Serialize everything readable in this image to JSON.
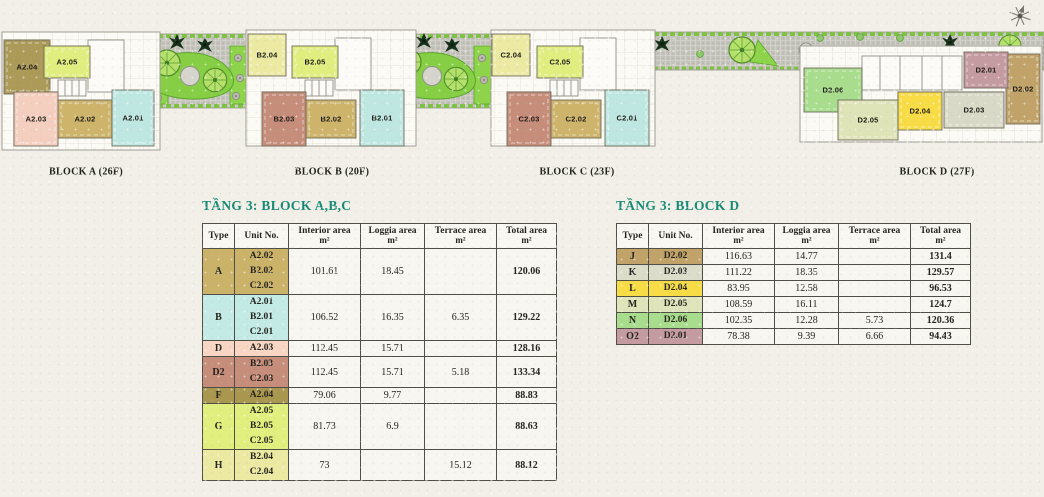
{
  "colors": {
    "title_teal": "#178a74",
    "paper": "#f1efe8",
    "table_border": "#504f47"
  },
  "plan": {
    "compass": "north-arrow",
    "blocks": [
      {
        "label": "BLOCK A (26F)",
        "cx": 86,
        "cy": 172
      },
      {
        "label": "BLOCK B (20F)",
        "cx": 332,
        "cy": 172
      },
      {
        "label": "BLOCK C (23F)",
        "cx": 577,
        "cy": 172
      },
      {
        "label": "BLOCK D (27F)",
        "cx": 937,
        "cy": 172
      }
    ],
    "units": [
      {
        "name": "A2.04",
        "color": "#ab9a58",
        "x": 4,
        "y": 40,
        "w": 46,
        "h": 54
      },
      {
        "name": "A2.05",
        "color": "#dfee7e",
        "x": 44,
        "y": 46,
        "w": 46,
        "h": 32
      },
      {
        "name": "A2.03",
        "color": "#f4cfc0",
        "x": 14,
        "y": 92,
        "w": 44,
        "h": 54
      },
      {
        "name": "A2.02",
        "color": "#cdb46a",
        "x": 58,
        "y": 100,
        "w": 54,
        "h": 38
      },
      {
        "name": "A2.01",
        "color": "#bfe7e2",
        "x": 112,
        "y": 90,
        "w": 42,
        "h": 56
      },
      {
        "name": "B2.04",
        "color": "#ece9a2",
        "x": 248,
        "y": 34,
        "w": 38,
        "h": 42
      },
      {
        "name": "B2.05",
        "color": "#dfee7e",
        "x": 292,
        "y": 46,
        "w": 46,
        "h": 32
      },
      {
        "name": "B2.03",
        "color": "#c68d7b",
        "x": 262,
        "y": 92,
        "w": 44,
        "h": 54
      },
      {
        "name": "B2.02",
        "color": "#cdb46a",
        "x": 306,
        "y": 100,
        "w": 50,
        "h": 38
      },
      {
        "name": "B2.01",
        "color": "#bfe7e2",
        "x": 360,
        "y": 90,
        "w": 44,
        "h": 56
      },
      {
        "name": "C2.04",
        "color": "#ece9a2",
        "x": 492,
        "y": 34,
        "w": 38,
        "h": 42
      },
      {
        "name": "C2.05",
        "color": "#dfee7e",
        "x": 537,
        "y": 46,
        "w": 46,
        "h": 32
      },
      {
        "name": "C2.03",
        "color": "#c68d7b",
        "x": 507,
        "y": 92,
        "w": 44,
        "h": 54
      },
      {
        "name": "C2.02",
        "color": "#cdb46a",
        "x": 551,
        "y": 100,
        "w": 50,
        "h": 38
      },
      {
        "name": "C2.01",
        "color": "#bfe7e2",
        "x": 605,
        "y": 90,
        "w": 44,
        "h": 56
      },
      {
        "name": "D2.06",
        "color": "#a9dd8e",
        "x": 804,
        "y": 68,
        "w": 58,
        "h": 44
      },
      {
        "name": "D2.05",
        "color": "#dfe3b8",
        "x": 838,
        "y": 100,
        "w": 60,
        "h": 40
      },
      {
        "name": "D2.04",
        "color": "#f8dc45",
        "x": 898,
        "y": 92,
        "w": 44,
        "h": 38
      },
      {
        "name": "D2.03",
        "color": "#d9d9c7",
        "x": 944,
        "y": 92,
        "w": 60,
        "h": 36
      },
      {
        "name": "D2.02",
        "color": "#c1a369",
        "x": 1006,
        "y": 54,
        "w": 34,
        "h": 70
      },
      {
        "name": "D2.01",
        "color": "#c49ba1",
        "x": 964,
        "y": 52,
        "w": 44,
        "h": 36
      }
    ]
  },
  "tables": [
    {
      "title": "TẦNG 3: BLOCK A,B,C",
      "headers": [
        {
          "t": "Type"
        },
        {
          "t": "Unit No."
        },
        {
          "t": "Interior area",
          "u": "m²"
        },
        {
          "t": "Loggia area",
          "u": "m²"
        },
        {
          "t": "Terrace area",
          "u": "m²"
        },
        {
          "t": "Total area",
          "u": "m²"
        }
      ],
      "rows": [
        {
          "type": "A",
          "color": "#cbb269",
          "units": [
            "A2.02",
            "B2.02",
            "C2.02"
          ],
          "interior": "101.61",
          "loggia": "18.45",
          "terrace": "",
          "total": "120.06"
        },
        {
          "type": "B",
          "color": "#c3eae4",
          "units": [
            "A2.01",
            "B2.01",
            "C2.01"
          ],
          "interior": "106.52",
          "loggia": "16.35",
          "terrace": "6.35",
          "total": "129.22"
        },
        {
          "type": "D",
          "color": "#f8d6c3",
          "units": [
            "A2.03"
          ],
          "interior": "112.45",
          "loggia": "15.71",
          "terrace": "",
          "total": "128.16"
        },
        {
          "type": "D2",
          "color": "#c68d7b",
          "units": [
            "B2.03",
            "C2.03"
          ],
          "interior": "112.45",
          "loggia": "15.71",
          "terrace": "5.18",
          "total": "133.34"
        },
        {
          "type": "F",
          "color": "#a9974f",
          "units": [
            "A2.04"
          ],
          "interior": "79.06",
          "loggia": "9.77",
          "terrace": "",
          "total": "88.83"
        },
        {
          "type": "G",
          "color": "#e0ef7e",
          "units": [
            "A2.05",
            "B2.05",
            "C2.05"
          ],
          "interior": "81.73",
          "loggia": "6.9",
          "terrace": "",
          "total": "88.63"
        },
        {
          "type": "H",
          "color": "#ece9a2",
          "units": [
            "B2.04",
            "C2.04"
          ],
          "interior": "73",
          "loggia": "",
          "terrace": "15.12",
          "total": "88.12"
        }
      ]
    },
    {
      "title": "TẦNG 3: BLOCK D",
      "headers": [
        {
          "t": "Type"
        },
        {
          "t": "Unit No."
        },
        {
          "t": "Interior area",
          "u": "m²"
        },
        {
          "t": "Loggia area",
          "u": "m²"
        },
        {
          "t": "Terrace area",
          "u": "m²"
        },
        {
          "t": "Total area",
          "u": "m²"
        }
      ],
      "rows": [
        {
          "type": "J",
          "color": "#c1a369",
          "units": [
            "D2.02"
          ],
          "interior": "116.63",
          "loggia": "14.77",
          "terrace": "",
          "total": "131.4"
        },
        {
          "type": "K",
          "color": "#dcdcca",
          "units": [
            "D2.03"
          ],
          "interior": "111.22",
          "loggia": "18.35",
          "terrace": "",
          "total": "129.57"
        },
        {
          "type": "L",
          "color": "#f8dc45",
          "units": [
            "D2.04"
          ],
          "interior": "83.95",
          "loggia": "12.58",
          "terrace": "",
          "total": "96.53"
        },
        {
          "type": "M",
          "color": "#e0e4bb",
          "units": [
            "D2.05"
          ],
          "interior": "108.59",
          "loggia": "16.11",
          "terrace": "",
          "total": "124.7"
        },
        {
          "type": "N",
          "color": "#a9dd8e",
          "units": [
            "D2.06"
          ],
          "interior": "102.35",
          "loggia": "12.28",
          "terrace": "5.73",
          "total": "120.36"
        },
        {
          "type": "O2",
          "color": "#c49ba1",
          "units": [
            "D2.01"
          ],
          "interior": "78.38",
          "loggia": "9.39",
          "terrace": "6.66",
          "total": "94.43"
        }
      ]
    }
  ]
}
